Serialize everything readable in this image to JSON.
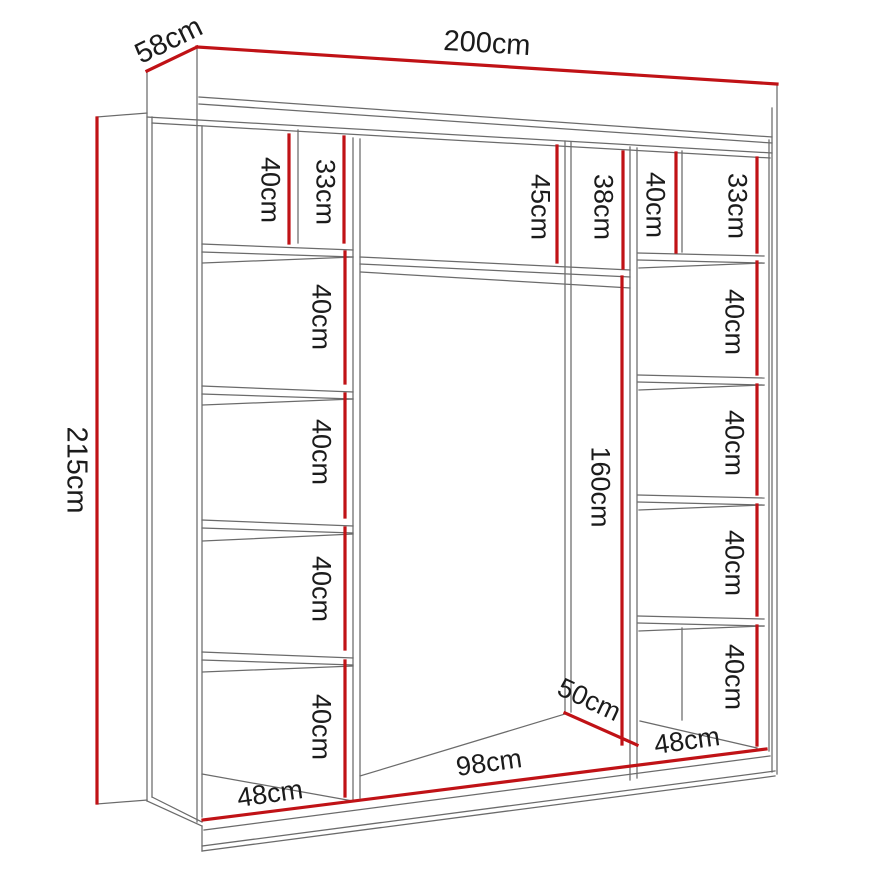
{
  "diagram": {
    "kind": "wardrobe-interior-dimensions",
    "accent_color": "#c01216",
    "line_color": "#6b6b6b",
    "overall": {
      "width": "200cm",
      "depth": "58cm",
      "height": "215cm"
    },
    "left_column": {
      "top_cell_a": "40cm",
      "top_cell_b": "33cm",
      "cells": [
        "40cm",
        "40cm",
        "40cm",
        "40cm"
      ],
      "bottom_width": "48cm"
    },
    "middle_section": {
      "top_cell_a": "45cm",
      "top_cell_b": "38cm",
      "hanging_space_height": "160cm",
      "interior_depth": "50cm",
      "bottom_width": "98cm"
    },
    "right_column": {
      "top_cell_a": "40cm",
      "top_cell_b": "33cm",
      "cells": [
        "40cm",
        "40cm",
        "40cm",
        "40cm"
      ],
      "bottom_width": "48cm"
    }
  }
}
